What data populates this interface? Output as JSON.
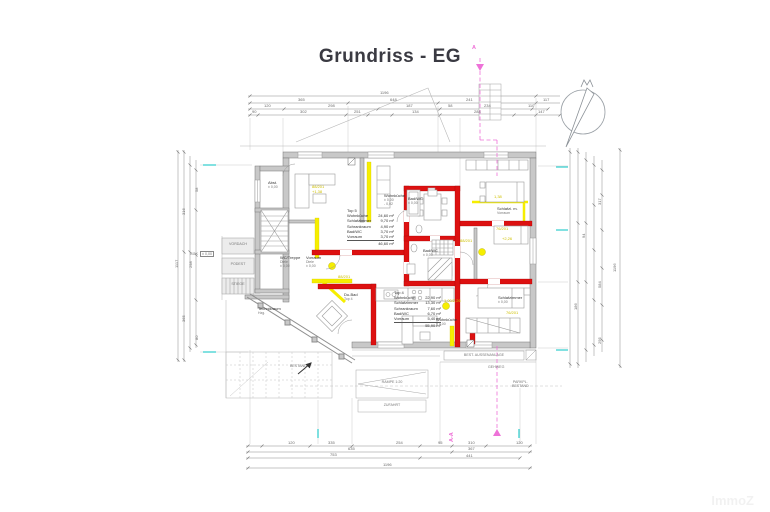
{
  "title": "Grundriss - EG",
  "watermark": "ImmoZ",
  "section": {
    "top": "A",
    "bottom": "A-A"
  },
  "icons": {
    "north_arrow": "north-arrow",
    "section_cut": "section-cut-line",
    "level_mark": "level-datum-mark"
  },
  "rooms": {
    "top5": {
      "name": "Top 5",
      "rows": [
        {
          "label": "Wohnküche",
          "area": "24,60 m²"
        },
        {
          "label": "Schlafzimmer",
          "area": "9,70 m²"
        },
        {
          "label": "Schrankraum",
          "area": "4,90 m²"
        },
        {
          "label": "Bad/WC",
          "area": "3,70 m²"
        },
        {
          "label": "Vorraum",
          "area": "3,70 m²"
        }
      ],
      "total": "46,60 m²"
    },
    "top4": {
      "name": "Top 4",
      "rows": [
        {
          "label": "Wohnküche",
          "area": "22,90 m²"
        },
        {
          "label": "Schlafzimmer",
          "area": "13,30 m²"
        },
        {
          "label": "Schrankraum",
          "area": "7,60 m²"
        },
        {
          "label": "Bad/WC",
          "area": "6,70 m²"
        },
        {
          "label": "Vorraum",
          "area": "5,40 m²"
        }
      ],
      "total": "55,90 m²"
    },
    "labels": {
      "abst": {
        "l1": "Abst.",
        "l2": "± 0,00"
      },
      "wc_treppe": {
        "l1": "WC/Treppe",
        "l2": "Diele",
        "l3": "± 0,00"
      },
      "vorraum": {
        "l1": "Vorraum",
        "l2": "Diele",
        "l3": "± 0,00"
      },
      "technik": {
        "l1": "Technikraum",
        "l2": "Hzg."
      },
      "du_bad": {
        "l1": "Du-Bad",
        "l2": "Top 4"
      },
      "bad_wc_1": {
        "l1": "Bad/WC",
        "l2": "± 0,00"
      },
      "bad_wc_2": {
        "l1": "Bad/WC",
        "l2": "± 0,00"
      },
      "wohnkueche_1": {
        "l1": "Wohnküche",
        "l2": "± 0,00",
        "l3": "- 0,02"
      },
      "wohnkueche_2": {
        "l1": "Wohnküche",
        "l2": "± 0,00"
      },
      "schlafzi_1": {
        "l1": "Schlafzi. m.",
        "l2": "Vorraum"
      },
      "schlafzi_2": {
        "l1": "Schlafzimmer",
        "l2": "± 0,00"
      }
    }
  },
  "site": {
    "gok": "GOK",
    "gok_value": "± 0,00",
    "vordach": "VORDACH",
    "podest": "PODEST",
    "stiege": "STIEGE",
    "bestand_left": "BESTAND",
    "rampe": "RAMPE 1:20",
    "zufahrt": "ZUFAHRT",
    "aussenanlage": "BEST. AUSSENANLAGE",
    "gehweg": "GEHWEG",
    "parkplatz_l1": "PARKPL.",
    "parkplatz_l2": "BESTAND"
  },
  "annotations": [
    {
      "x": 380,
      "y": 90,
      "t": "1196"
    },
    {
      "x": 298,
      "y": 97,
      "t": "365"
    },
    {
      "x": 390,
      "y": 97,
      "t": "648"
    },
    {
      "x": 466,
      "y": 97,
      "t": "241"
    },
    {
      "x": 543,
      "y": 97,
      "t": "117"
    },
    {
      "x": 264,
      "y": 103,
      "t": "120"
    },
    {
      "x": 328,
      "y": 103,
      "t": "298"
    },
    {
      "x": 406,
      "y": 103,
      "t": "187"
    },
    {
      "x": 448,
      "y": 103,
      "t": "58"
    },
    {
      "x": 484,
      "y": 103,
      "t": "234"
    },
    {
      "x": 528,
      "y": 103,
      "t": "110"
    },
    {
      "x": 252,
      "y": 109,
      "t": "90"
    },
    {
      "x": 300,
      "y": 109,
      "t": "302"
    },
    {
      "x": 354,
      "y": 109,
      "t": "251"
    },
    {
      "x": 412,
      "y": 109,
      "t": "134"
    },
    {
      "x": 474,
      "y": 109,
      "t": "284"
    },
    {
      "x": 538,
      "y": 109,
      "t": "147"
    },
    {
      "x": 174,
      "y": 268,
      "t": "1117",
      "r": -90
    },
    {
      "x": 181,
      "y": 215,
      "t": "316",
      "r": -90
    },
    {
      "x": 181,
      "y": 322,
      "t": "365",
      "r": -90
    },
    {
      "x": 188,
      "y": 268,
      "t": "298",
      "r": -90
    },
    {
      "x": 194,
      "y": 192,
      "t": "58",
      "r": -90
    },
    {
      "x": 194,
      "y": 340,
      "t": "80",
      "r": -90
    },
    {
      "x": 612,
      "y": 272,
      "t": "1196",
      "r": -90
    },
    {
      "x": 597,
      "y": 205,
      "t": "317",
      "r": -90
    },
    {
      "x": 597,
      "y": 288,
      "t": "584",
      "r": -90
    },
    {
      "x": 597,
      "y": 344,
      "t": "295",
      "r": -90
    },
    {
      "x": 581,
      "y": 238,
      "t": "94",
      "r": -90
    },
    {
      "x": 573,
      "y": 310,
      "t": "186",
      "r": -90
    },
    {
      "x": 288,
      "y": 440,
      "t": "120"
    },
    {
      "x": 328,
      "y": 440,
      "t": "335"
    },
    {
      "x": 396,
      "y": 440,
      "t": "254"
    },
    {
      "x": 438,
      "y": 440,
      "t": "95"
    },
    {
      "x": 468,
      "y": 440,
      "t": "310"
    },
    {
      "x": 516,
      "y": 440,
      "t": "120"
    },
    {
      "x": 348,
      "y": 446,
      "t": "635"
    },
    {
      "x": 468,
      "y": 446,
      "t": "367"
    },
    {
      "x": 330,
      "y": 452,
      "t": "753"
    },
    {
      "x": 466,
      "y": 453,
      "t": "441"
    },
    {
      "x": 383,
      "y": 462,
      "t": "1196"
    },
    {
      "x": 312,
      "y": 184,
      "t": "88/201",
      "c": "#cfc000"
    },
    {
      "x": 312,
      "y": 189,
      "t": "+1,38",
      "c": "#cfc000"
    },
    {
      "x": 494,
      "y": 194,
      "t": "1,38",
      "c": "#cfc000"
    },
    {
      "x": 496,
      "y": 226,
      "t": "76/201",
      "c": "#cfc000"
    },
    {
      "x": 460,
      "y": 238,
      "t": "88/201",
      "c": "#cfc000"
    },
    {
      "x": 502,
      "y": 236,
      "t": "+2,26",
      "c": "#cfc000"
    },
    {
      "x": 506,
      "y": 310,
      "t": "76/201",
      "c": "#cfc000"
    },
    {
      "x": 444,
      "y": 298,
      "t": "1,00/2,26",
      "c": "#cfc000"
    },
    {
      "x": 338,
      "y": 274,
      "t": "88/201",
      "c": "#cfc000"
    }
  ]
}
